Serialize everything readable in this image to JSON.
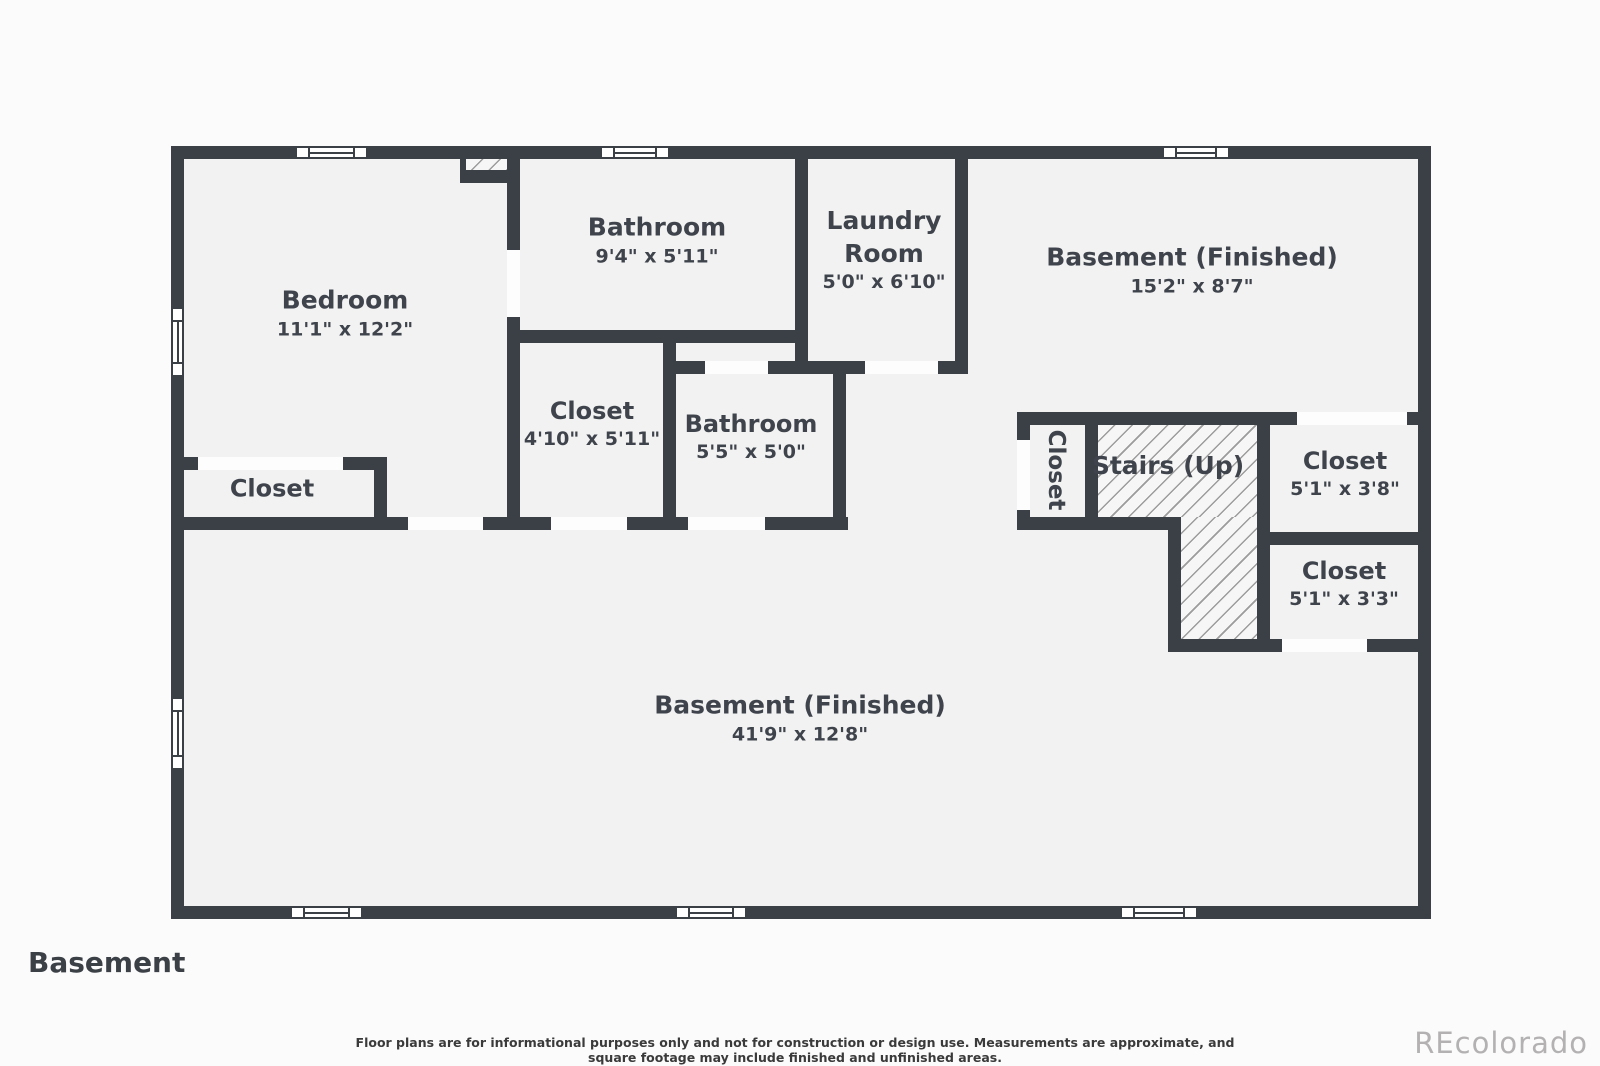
{
  "floor_label": "Basement",
  "disclaimer": "Floor plans are for informational purposes only and not for construction or design use. Measurements are approximate, and square footage may include finished and unfinished areas.",
  "watermark": "REcolorado",
  "colors": {
    "wall": "#3b4046",
    "room_fill": "#f2f2f2",
    "page_background": "#fbfbfb",
    "label_text": "#3f444c",
    "hatch_line": "#9c9c9c",
    "watermark_text": "#b3b1b1"
  },
  "rooms": [
    {
      "name": "Bedroom",
      "dims": "11'1\" x 12'2\""
    },
    {
      "name": "Bathroom",
      "dims": "9'4\" x 5'11\""
    },
    {
      "name": "Laundry Room",
      "dims": "5'0\" x 6'10\""
    },
    {
      "name": "Basement (Finished)",
      "dims": "15'2\" x 8'7\""
    },
    {
      "name": "Closet",
      "dims": ""
    },
    {
      "name": "Closet",
      "dims": "4'10\" x 5'11\""
    },
    {
      "name": "Bathroom",
      "dims": "5'5\" x 5'0\""
    },
    {
      "name": "Closet",
      "dims": ""
    },
    {
      "name": "Stairs (Up)",
      "dims": ""
    },
    {
      "name": "Closet",
      "dims": "5'1\" x 3'8\""
    },
    {
      "name": "Closet",
      "dims": "5'1\" x 3'3\""
    },
    {
      "name": "Basement (Finished)",
      "dims": "41'9\" x 12'8\""
    }
  ]
}
